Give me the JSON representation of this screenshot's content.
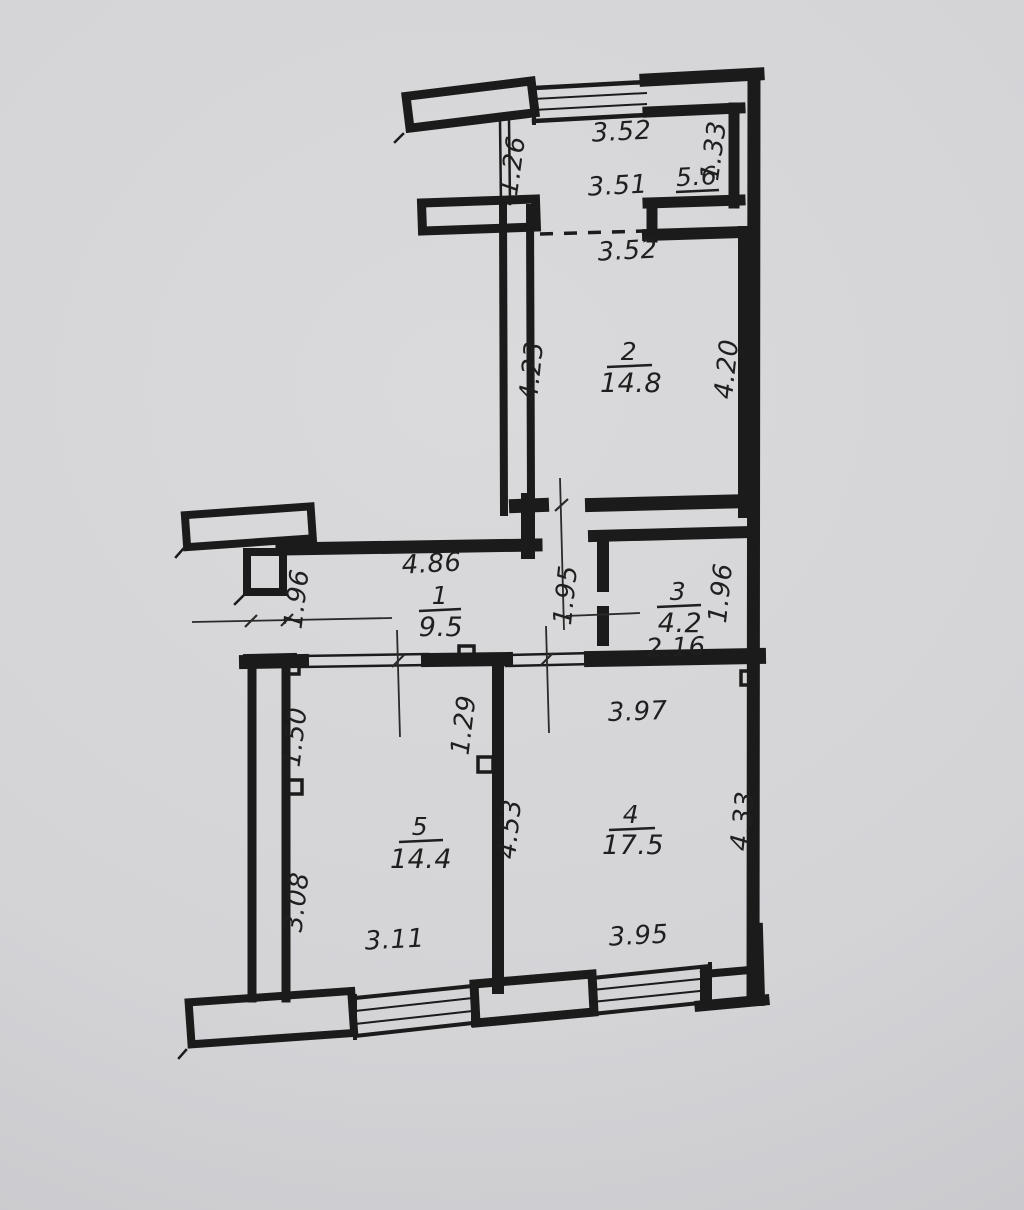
{
  "rooms": {
    "r1": {
      "number": "1",
      "area": "9.5"
    },
    "r2": {
      "number": "2",
      "area": "14.8"
    },
    "r3": {
      "number": "3",
      "area": "4.2"
    },
    "r4": {
      "number": "4",
      "area": "17.5"
    },
    "r5": {
      "number": "5",
      "area": "14.4"
    },
    "loggia": {
      "area": "5.6"
    }
  },
  "dimensions": {
    "top_window": "3.52",
    "loggia_width": "3.51",
    "loggia_left": "1.26",
    "loggia_right": "1.33",
    "loggia_bottom": "3.52",
    "r2_left": "4.23",
    "r2_right": "4.20",
    "r1_width": "4.86",
    "r1_left": "1.96",
    "r1_right": "1.95",
    "r3_right": "1.96",
    "r3_width": "2.16",
    "r5_upper_left": "1.50",
    "r5_door": "1.29",
    "r4_top": "3.97",
    "r4_left": "4.53",
    "r4_right": "4.33",
    "r5_left": "3.08",
    "r5_bottom": "3.11",
    "r4_bottom": "3.95"
  },
  "colors": {
    "wall": "#1b1b1b",
    "paper": "#d4d4d7",
    "thin_line": "#2a2a2a"
  }
}
